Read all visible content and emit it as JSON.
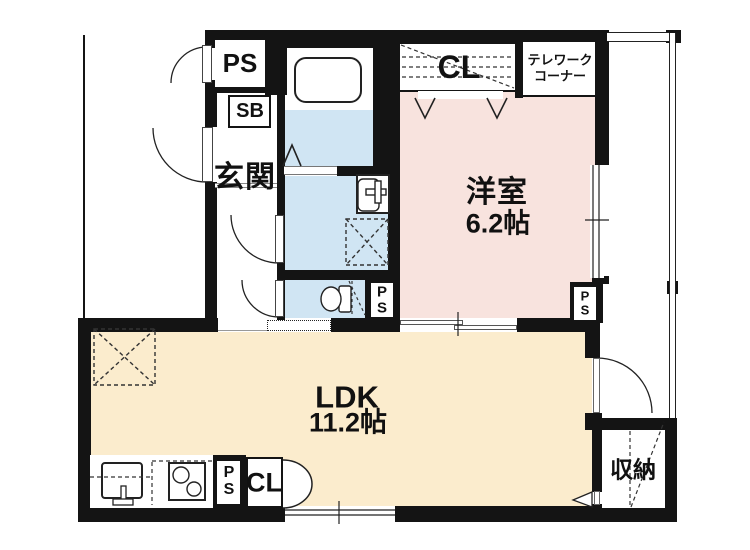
{
  "plan": {
    "rooms": {
      "entrance": {
        "label": "玄関"
      },
      "western": {
        "label": "洋室",
        "size": "6.2帖"
      },
      "ldk": {
        "label": "LDK",
        "size": "11.2帖"
      },
      "storage": {
        "label": "収納"
      },
      "telework": {
        "line1": "テレワーク",
        "line2": "コーナー"
      }
    },
    "closets": {
      "top": "CL",
      "bottom": "CL"
    },
    "shafts": {
      "ps": "PS",
      "sb": "SB",
      "p": "P",
      "s": "S"
    },
    "colors": {
      "wall": "#141414",
      "pink": "#f8e3de",
      "cream": "#fbeccd",
      "blue": "#d0e5f3",
      "line": "#222222"
    }
  }
}
